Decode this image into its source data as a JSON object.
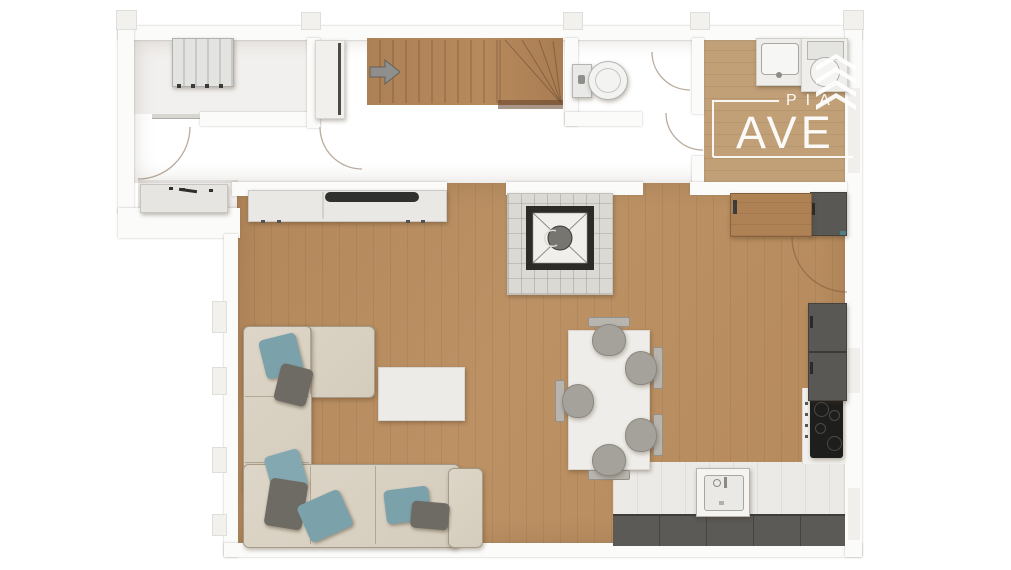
{
  "watermark": {
    "line1": "PIA",
    "line2": "AVE",
    "icon": "stacked-chevrons-logo-icon"
  },
  "floorplan": {
    "type": "top-down-3d-rendered-floor-plan",
    "rooms": [
      {
        "name": "top-left-room",
        "items": [
          "radiator",
          "door-swing"
        ]
      },
      {
        "name": "hallway",
        "items": [
          "desk",
          "built-in-closet",
          "staircase-with-winder",
          "stair-direction-arrow"
        ]
      },
      {
        "name": "wc",
        "items": [
          "toilet"
        ]
      },
      {
        "name": "bathroom-top-right",
        "items": [
          "washbasin",
          "round-toilet"
        ]
      },
      {
        "name": "living-room",
        "items": [
          "corner-sofa",
          "throw-pillows-x7",
          "coffee-table",
          "tv-sideboard",
          "stone-fireplace"
        ]
      },
      {
        "name": "dining-area",
        "items": [
          "dining-table",
          "chairs-x5"
        ]
      },
      {
        "name": "kitchen",
        "items": [
          "sink",
          "cooktop",
          "base-cabinets",
          "tall-cabinets",
          "wood-cabinet",
          "door-swing"
        ]
      }
    ],
    "colors": {
      "wood_hall": "#a98157",
      "wood_living": "#b68b5e",
      "wood_bath": "#c1a078",
      "wall": "#fbfbfa",
      "kitchen_tile": "#eceae6",
      "cabinet_dark": "#5b5a57",
      "cooktop_black": "#1e1e1c",
      "sofa_cream": "#d9d2c3",
      "pillow_blue": "#7ba1ab",
      "pillow_gray": "#6e6b65",
      "chair_gray": "#a5a19b",
      "fireplace_frame": "#2c2b28",
      "fireplace_stone": "#dbd9d4",
      "watermark": "#ffffff"
    }
  }
}
